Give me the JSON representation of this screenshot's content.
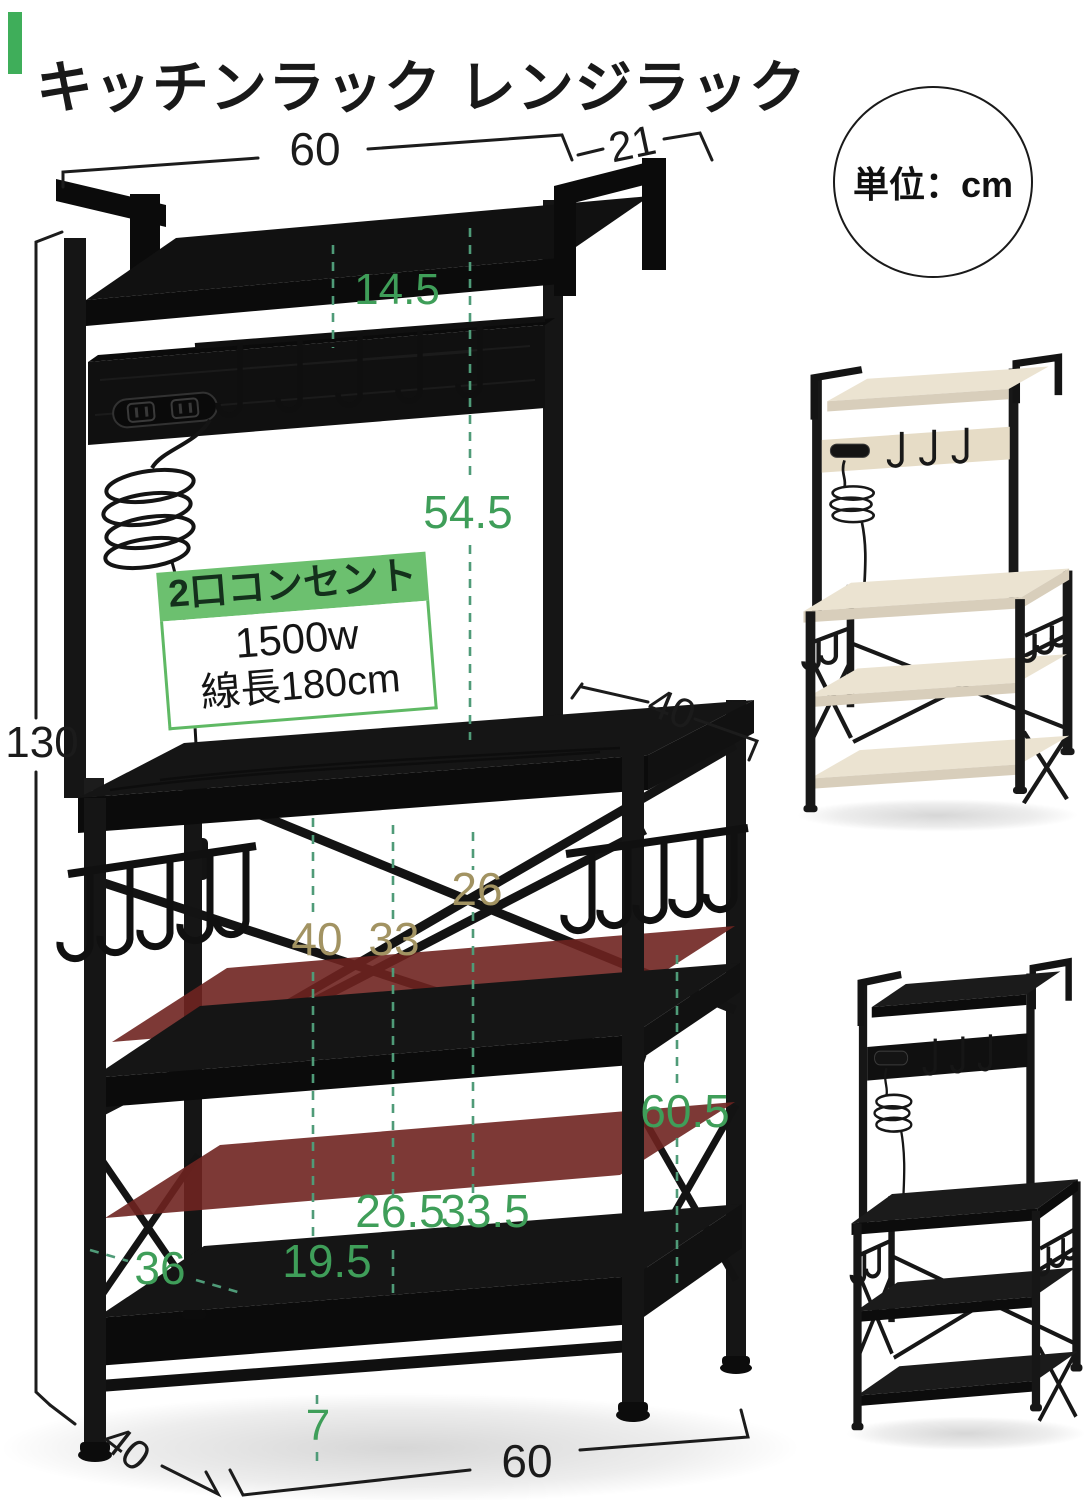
{
  "header": {
    "title": "キッチンラック レンジラック"
  },
  "unit_badge": {
    "text": "単位：cm"
  },
  "outlet_badge": {
    "title": "2口コンセント",
    "power": "1500w",
    "cord_length": "線長180cm"
  },
  "dimensions": {
    "top_shelf_width": "60",
    "top_shelf_depth": "21",
    "hooks_drop": "14.5",
    "upper_section_height": "54.5",
    "total_height": "130",
    "counter_depth": "40",
    "counter_diagonal": "26",
    "counter_inner_width": "40",
    "counter_inner_mid": "33",
    "right_section_height": "60.5",
    "middle_gap_front": "26.5",
    "middle_gap_rear": "33.5",
    "lower_clearance": "19.5",
    "base_inner_width": "36",
    "foot_height": "7",
    "base_depth": "40",
    "base_width": "60"
  },
  "colors": {
    "accent_green": "#3fae5a",
    "badge_green": "#6cc06f",
    "dim_green": "#3f9e59",
    "dim_olive": "#a29362",
    "dashed_line": "#4f9b78",
    "red_overlay": "#6f2320",
    "frame_black": "#151515",
    "wood_light": "#ebe3d1"
  }
}
